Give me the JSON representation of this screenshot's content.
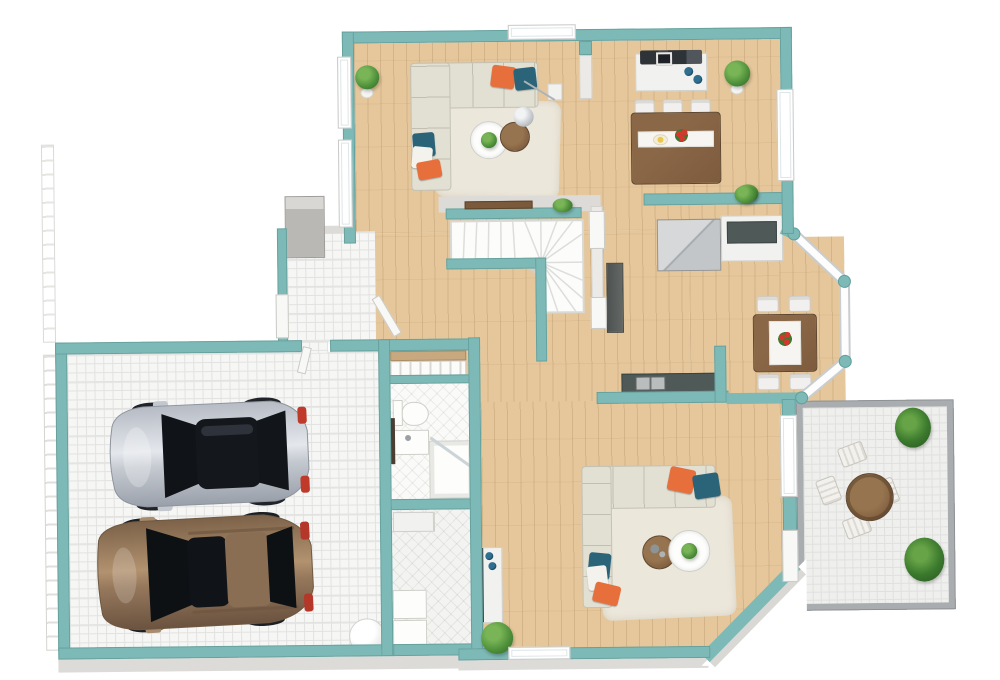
{
  "scene": {
    "kind": "3d-floor-plan-render",
    "view": "top-down oblique",
    "level": "ground floor",
    "background": "white"
  },
  "palette": {
    "wall_teal": "#7db9b6",
    "wall_face": "#dcdbd8",
    "wood_floor": "#e5c79b",
    "rug": "#ece7db",
    "sofa": "#e2dfd3",
    "pillow_orange": "#e76f3b",
    "pillow_teal": "#2b6478",
    "pillow_white": "#f4f2ec",
    "table_brown": "#7d5b3d",
    "chair_white": "#f1f0ee",
    "plant_green": "#4e8f3a",
    "counter_dark": "#4f5a58",
    "cabinet_gray": "#c9cbce",
    "decor_blue": "#2f6f90",
    "car_silver": "#c6cbd2",
    "car_brown": "#96785c",
    "car_glass": "#14171c",
    "taillight_red": "#c03a2b",
    "stone_gray": "#b9b8b4",
    "railing_gray": "#a9adb0",
    "stair_white": "#fcfcfb"
  },
  "rooms": [
    {
      "name": "living-room",
      "floor": "hardwood"
    },
    {
      "name": "dining-area",
      "floor": "hardwood"
    },
    {
      "name": "kitchen",
      "floor": "hardwood"
    },
    {
      "name": "breakfast-nook",
      "floor": "hardwood",
      "feature": "bay-windows"
    },
    {
      "name": "entry-hall",
      "floor": "mosaic-tile",
      "feature": "stone-chimney-column"
    },
    {
      "name": "staircase",
      "type": "l-shaped-winder"
    },
    {
      "name": "bathroom",
      "floor": "ceramic-tile"
    },
    {
      "name": "laundry-room",
      "floor": "ceramic-tile"
    },
    {
      "name": "family-room",
      "floor": "hardwood"
    },
    {
      "name": "garage",
      "floor": "mosaic-tile",
      "capacity": "2 cars"
    },
    {
      "name": "patio",
      "floor": "stone-tile",
      "feature": "gray-railing"
    }
  ],
  "furniture": {
    "living_room": [
      "l-shaped-sectional-sofa",
      "orange-pillow",
      "teal-pillows",
      "white-pillow",
      "area-rug",
      "round-white-coffee-table-with-plant",
      "round-wood-side-table",
      "floor-lamp",
      "white-side-cabinet",
      "potted-plant"
    ],
    "dining_area": [
      "rectangular-wood-table",
      "six-white-chairs",
      "white-runner-with-plate-and-flowers",
      "media-sideboard-with-electronics",
      "blue-vases",
      "potted-plant",
      "small-plant"
    ],
    "kitchen": [
      "gray-double-fridge",
      "white-cabinet-dark-top",
      "tall-dark-cabinet",
      "dark-counter-with-double-sink"
    ],
    "breakfast_nook": [
      "square-wood-table",
      "four-white-chairs",
      "red-flower-centerpiece"
    ],
    "bathroom": [
      "toilet",
      "vanity-sink",
      "corner-shower-with-glass-door",
      "slatted-closet-shelves",
      "dark-wood-door"
    ],
    "laundry_room": [
      "washer",
      "dryer",
      "storage-cabinet"
    ],
    "family_room": [
      "l-shaped-sectional-sofa",
      "orange-pillows",
      "teal-pillows",
      "white-pillow",
      "area-rug",
      "round-white-coffee-table-with-plant",
      "round-wood-side-table-with-candles",
      "white-console-with-blue-decor",
      "potted-plant"
    ],
    "garage": [
      "silver-sedan",
      "brown-suv",
      "round-white-tank"
    ],
    "patio": [
      "round-wood-table",
      "four-striped-lounge-chairs",
      "corner-planter-north",
      "corner-planter-south"
    ]
  },
  "counts": {
    "cars": 2,
    "sectional_sofas": 2,
    "dining_seats": 6,
    "nook_seats": 4,
    "patio_seats": 4,
    "potted_plants": 9,
    "windows": 8
  }
}
